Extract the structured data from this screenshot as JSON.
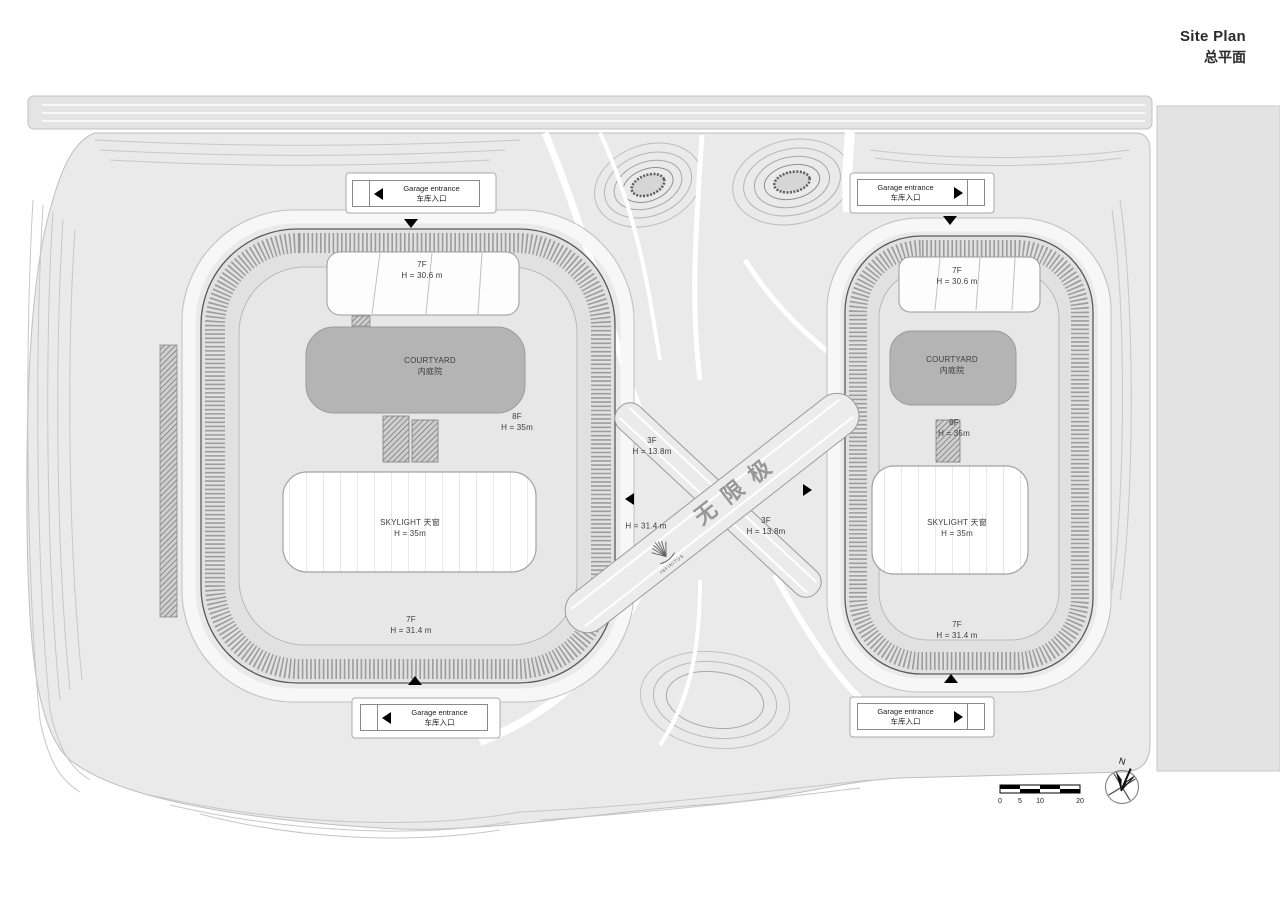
{
  "title": {
    "en": "Site Plan",
    "zh": "总平面"
  },
  "buildings": {
    "left": {
      "roof_bar": {
        "floors": "7F",
        "height": "H = 30.6 m"
      },
      "courtyard": {
        "en": "COURTYARD",
        "zh": "内庭院"
      },
      "block_rear": {
        "floors": "8F",
        "height": "H = 35m"
      },
      "skylight": {
        "title": "SKYLIGHT 天窗",
        "height": "H = 35m"
      },
      "block_front": {
        "floors": "7F",
        "height": "H = 31.4 m"
      }
    },
    "right": {
      "roof_bar": {
        "floors": "7F",
        "height": "H = 30.6 m"
      },
      "courtyard": {
        "en": "COURTYARD",
        "zh": "内庭院"
      },
      "block_rear": {
        "floors": "8F",
        "height": "H = 35m"
      },
      "skylight": {
        "title": "SKYLIGHT 天窗",
        "height": "H = 35m"
      },
      "block_front": {
        "floors": "7F",
        "height": "H = 31.4 m"
      }
    }
  },
  "center": {
    "bridge_upper": {
      "floors": "3F",
      "height": "H = 13.8m"
    },
    "walkway_height": "H = 31.4 m",
    "bridge_lower": {
      "floors": "3F",
      "height": "H = 13.8m"
    },
    "brand": {
      "zh": "无限极",
      "en": "INFINITUS"
    }
  },
  "garage_entrances": [
    {
      "position": "top-left",
      "line1": "Garage entrance",
      "line2": "车库入口",
      "direction": "left"
    },
    {
      "position": "top-right",
      "line1": "Garage entrance",
      "line2": "车库入口",
      "direction": "right"
    },
    {
      "position": "bottom-left",
      "line1": "Garage entrance",
      "line2": "车库入口",
      "direction": "left"
    },
    {
      "position": "bottom-right",
      "line1": "Garage entrance",
      "line2": "车库入口",
      "direction": "right"
    }
  ],
  "scale_bar": {
    "ticks": [
      "0",
      "5",
      "10",
      "20"
    ]
  },
  "compass": {
    "label": "N"
  },
  "colors": {
    "site": "#eaeaea",
    "courtyard": "#b4b4b4",
    "hatch": "#8f8f8f",
    "roof": "#e7e7e7",
    "accent": "#000000"
  }
}
